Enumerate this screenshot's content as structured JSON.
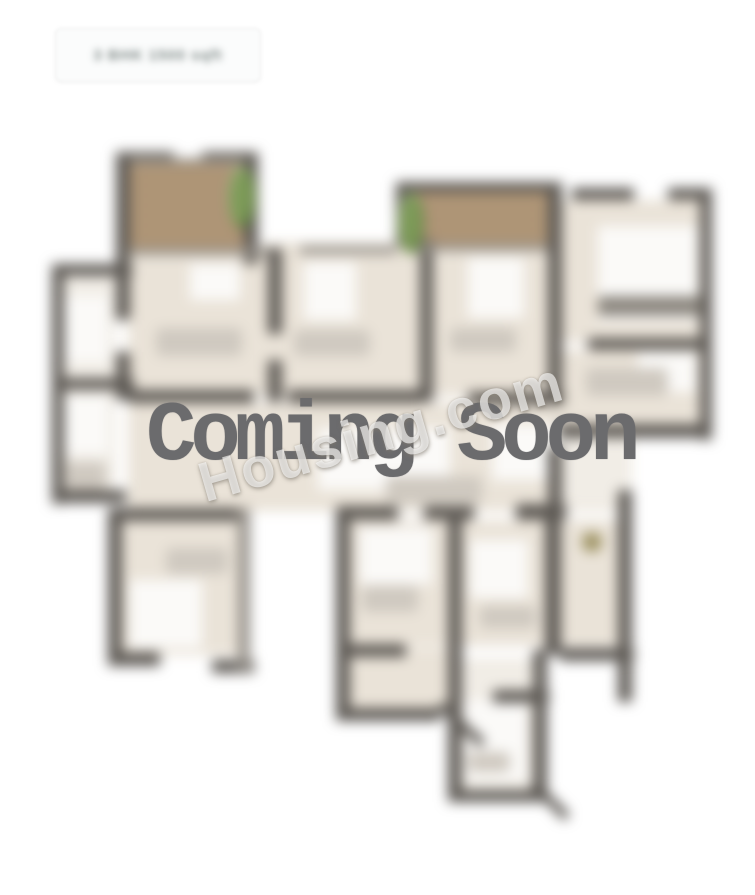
{
  "badge": {
    "label": "3 BHK 1500 sqft"
  },
  "overlay": {
    "coming_soon": "Coming Soon",
    "watermark": "Housing.com"
  },
  "colors": {
    "wall": "#5d5954",
    "wall-light": "#96918a",
    "floor": "#eae3d8",
    "floor-light": "#f1ede6",
    "white-area": "#fbfaf8",
    "deck": "#b59c7d",
    "plant": "#7d9b58",
    "furniture": "#cfc9c0",
    "furniture-dark": "#8d8880",
    "dot": "#9c9161",
    "coming-text": "#6b6b6d",
    "badge-border": "#ececec",
    "badge-text": "#7e8886"
  }
}
